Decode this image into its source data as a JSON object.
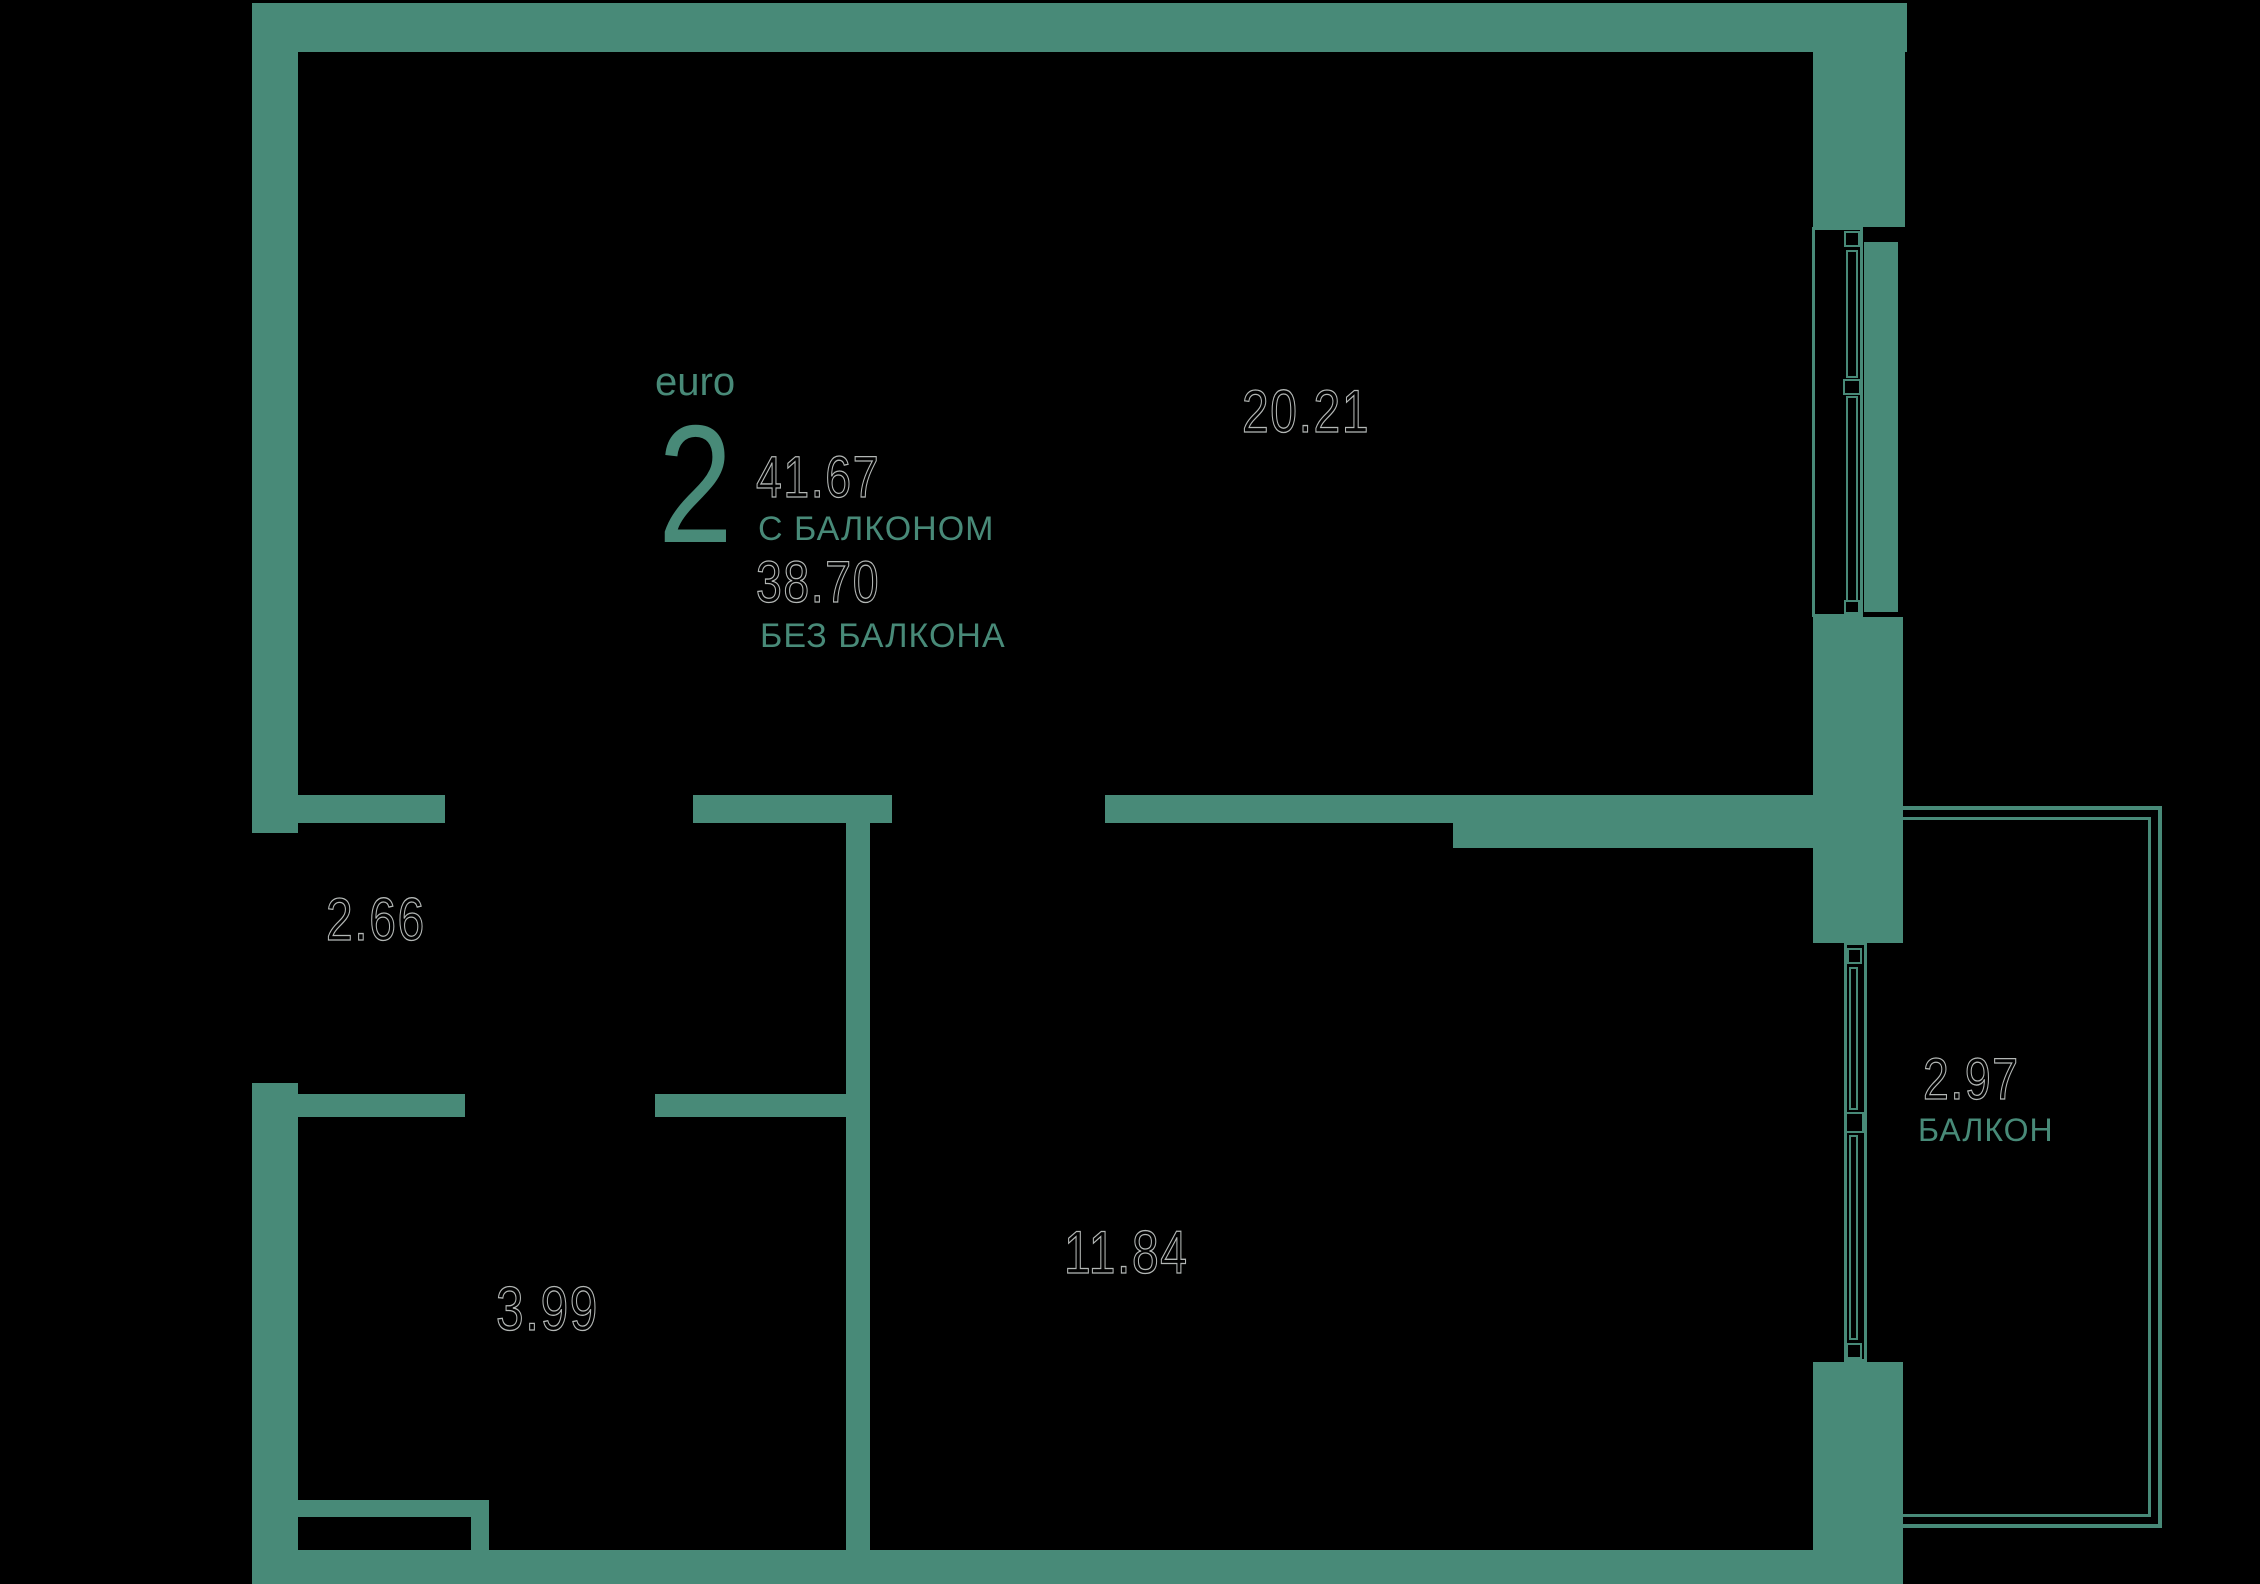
{
  "title_block": {
    "plan_type": "euro",
    "rooms_count": "2",
    "area_with_balcony": "41.67",
    "with_balcony_label": "С БАЛКОНОМ",
    "area_without_balcony": "38.70",
    "without_balcony_label": "БЕЗ БАЛКОНА"
  },
  "rooms": {
    "kitchen_living": {
      "area": "20.21"
    },
    "hallway": {
      "area": "2.66"
    },
    "bathroom": {
      "area": "3.99"
    },
    "bedroom": {
      "area": "11.84"
    },
    "balcony": {
      "area": "2.97",
      "label": "БАЛКОН"
    }
  },
  "colors": {
    "background": "#000000",
    "wall": "#488a78",
    "accent_text": "#488a78",
    "area_number_outline": "#b3b7b5"
  }
}
